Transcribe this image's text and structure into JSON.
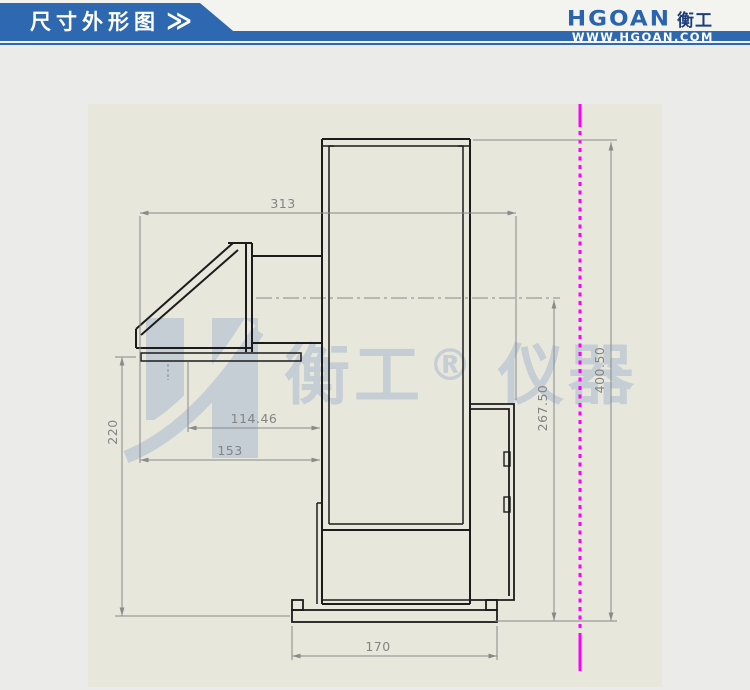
{
  "header": {
    "title": "尺寸外形图",
    "chevrons": "≫",
    "brand": {
      "name": "HGOAN",
      "cn": "衡工",
      "website": "WWW.HGOAN.COM"
    },
    "colors": {
      "banner_blue": "#2e68b1",
      "logo_blue": "#2b64ae",
      "logo_navy": "#1d3e78"
    }
  },
  "watermark": {
    "logo_letter": "H",
    "cn_left": "衡工",
    "reg_mark": "®",
    "cn_right": "仪器",
    "color": "#c5cdd5"
  },
  "drawing": {
    "type": "technical-dimension-diagram",
    "dimensions": {
      "overall_width": "313",
      "inlet_offset": "114.46",
      "hood_width": "153",
      "hood_height": "220",
      "axis_height": "267.50",
      "overall_height": "400.50",
      "base_width": "170"
    },
    "colors": {
      "canvas": "#e7e7db",
      "line": "#1c1c1c",
      "dimension": "#8a8a8a",
      "construction_line": "#ff00ff",
      "watermark": "#c5cdd5"
    }
  }
}
